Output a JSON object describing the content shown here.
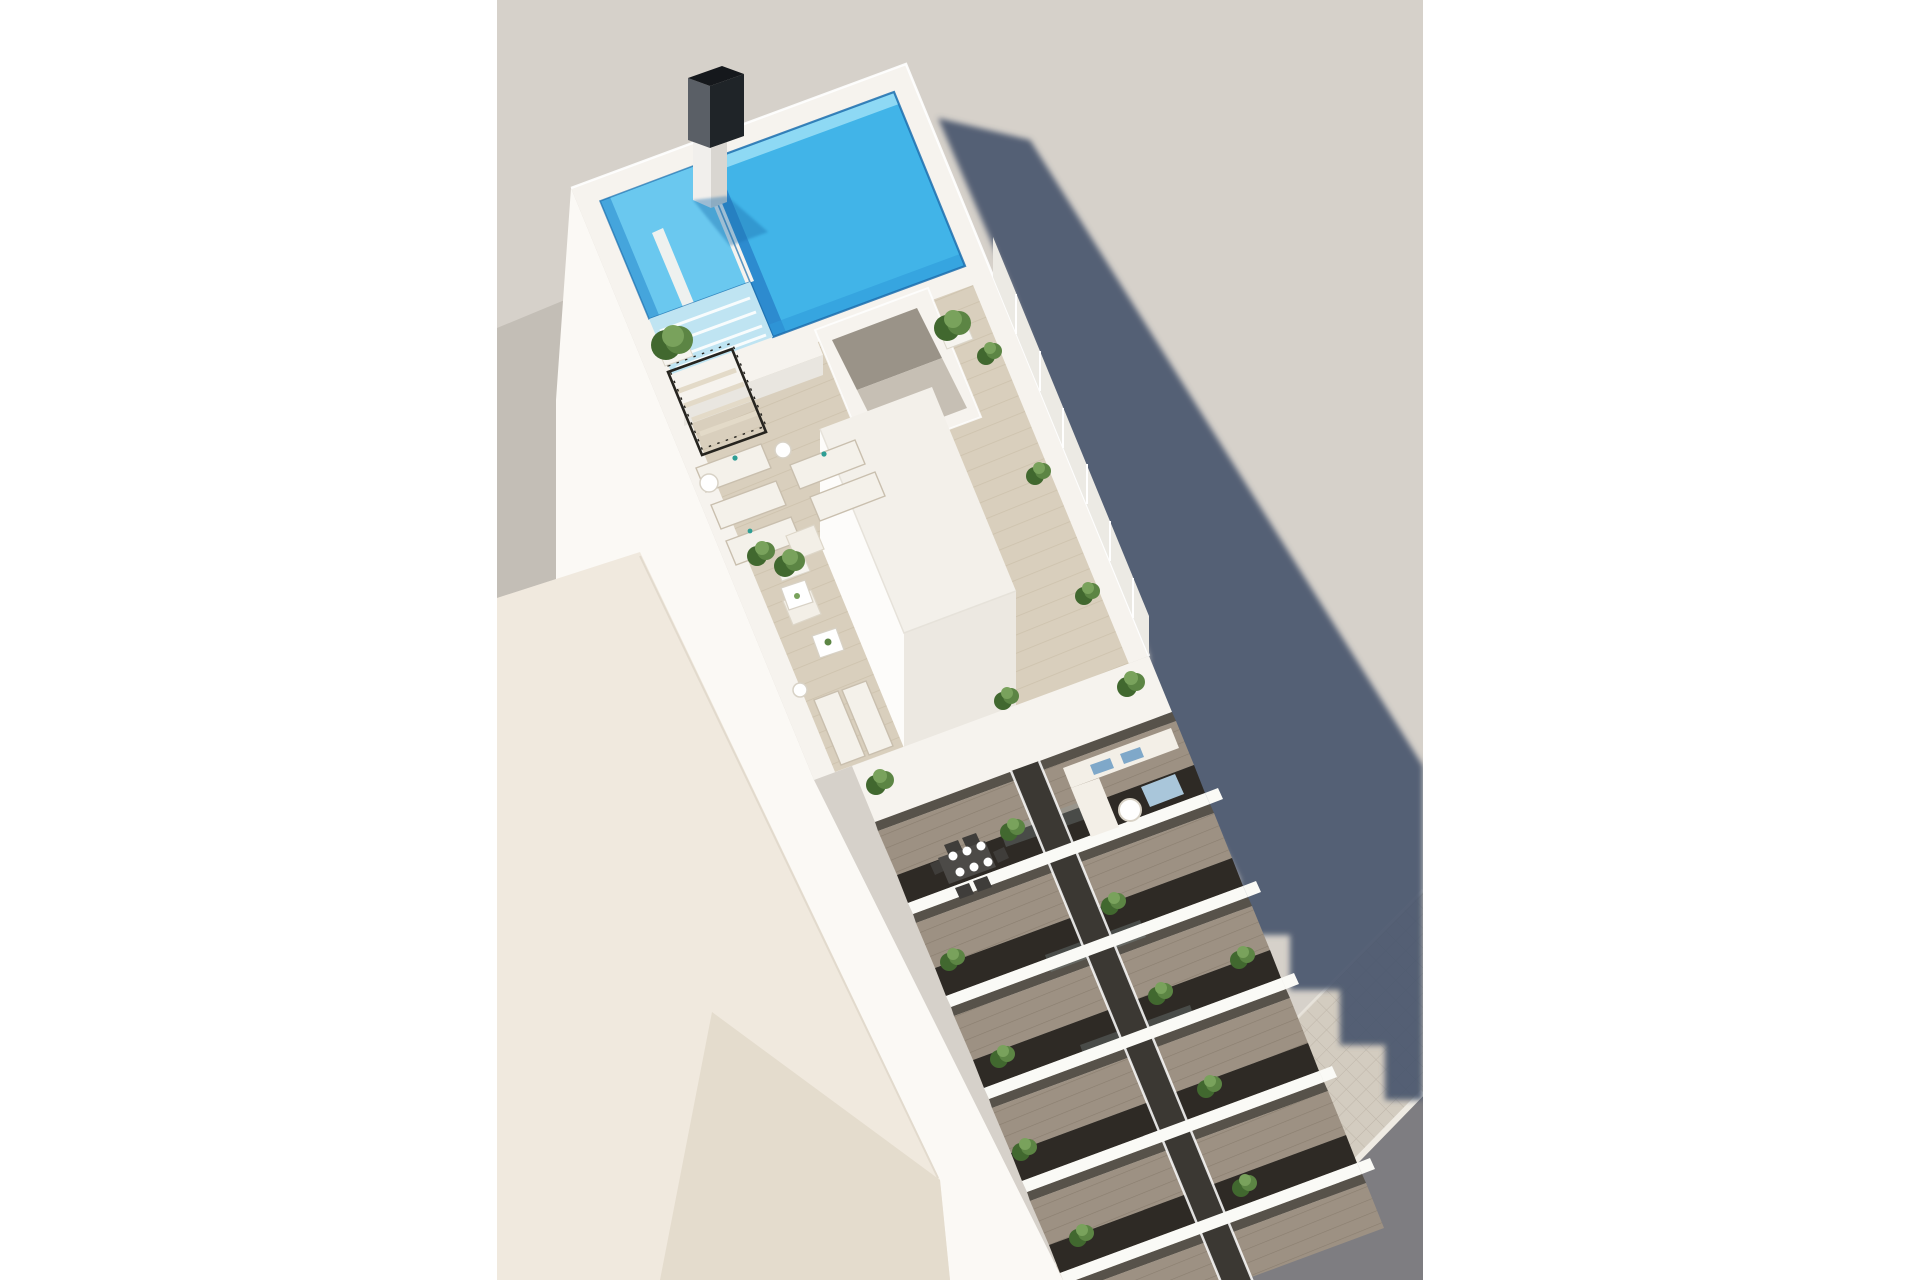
{
  "meta": {
    "title": "Aerial 3D architectural render",
    "description": "Aerial 3D rendering of a modern white apartment building with a rooftop swimming pool, a furnished roof terrace with sun loungers, two columns of stacked balconies with plants and furniture, a neighboring low cream building, a tiled sidewalk and asphalt road, and a long afternoon shadow cast on the light gray ground."
  },
  "scene": {
    "setting": "sunny exterior, top-down oblique view, light warm-gray ground plane, white page margins left and right",
    "features": [
      "rooftop pool",
      "kids splash pool with steps",
      "black chimney stack",
      "roof terrace with wood decking",
      "black metal stair railing",
      "open patio lightwell",
      "rooftop stair housing volume",
      "lounge corner with armchairs and coffee tables",
      "sun loungers with side tables",
      "potted green plants",
      "glass-panel parapet",
      "two columns of stacked balconies",
      "dining table with plates on balcony",
      "balcony sofa with blue cushions",
      "neighboring low cream building",
      "tiled sidewalk",
      "asphalt road",
      "long cast building shadow with stepped edge"
    ],
    "counts": {
      "balcony_floors_visible": 6,
      "balcony_columns": 2,
      "terrace_sun_loungers": 7,
      "terrace_trees_and_plants": 10,
      "balcony_plants": 10,
      "east_parapet_glass_bushes": 3
    }
  },
  "colors": {
    "page_bg": "#ffffff",
    "ground": "#d6d1ca",
    "shadow": "#47536b",
    "neighbor_gray": "#c3beb6",
    "cream_light": "#f0e9de",
    "cream_dark": "#e4dccd",
    "wall_white": "#fbf9f5",
    "roof_white": "#f6f3ee",
    "housing_top": "#f3f0ea",
    "housing_west": "#fdfcfa",
    "housing_south": "#ece8e1",
    "pool_main": "#41b4e8",
    "pool_light": "#8ed9f4",
    "pool_dark": "#2b86cc",
    "pool_deep": "#2f9bdb",
    "waterline": "#1d6fae",
    "kids_pool": "#6ac8ef",
    "kids_dark": "#3e9fd8",
    "wetdeck": "#bfe4f2",
    "chimney_top": "#15181c",
    "chimney_front": "#1f2428",
    "chimney_side": "#5a5f66",
    "column_light": "#f1efec",
    "column_shade": "#d9d6d1",
    "pool_shadow": "#1c6fae",
    "wood": "#d9cfbd",
    "wood_stripe": "#cdc2ad",
    "patio_dark": "#9a9388",
    "patio_mid": "#c6bfb4",
    "glass_band": "#eceae4",
    "slab_white": "#fafaf6",
    "tower_glass": "#2e2a25",
    "glass_streak": "#8fa3a5",
    "balcony_floor": "#9d9183",
    "door_strip": "#57524a",
    "recess": "#3b3833",
    "sidewalk": "#d3ccc0",
    "tile_line": "#beb6a9",
    "road": "#7e7d81",
    "curb": "#efebe3",
    "plant_dark": "#41682f",
    "plant_mid": "#5c8544",
    "plant_light": "#79a25c",
    "planter": "#f6f4ef",
    "lounger": "#f4f1ea",
    "lounger_frame": "#c9bfae",
    "sofa": "#f3efe7",
    "cushion_blue": "#7fa8c9",
    "cushion_blue_light": "#a9c6da",
    "table_dark": "#4c4a47",
    "railing": "#26241f",
    "steps": "#e3dac8"
  }
}
